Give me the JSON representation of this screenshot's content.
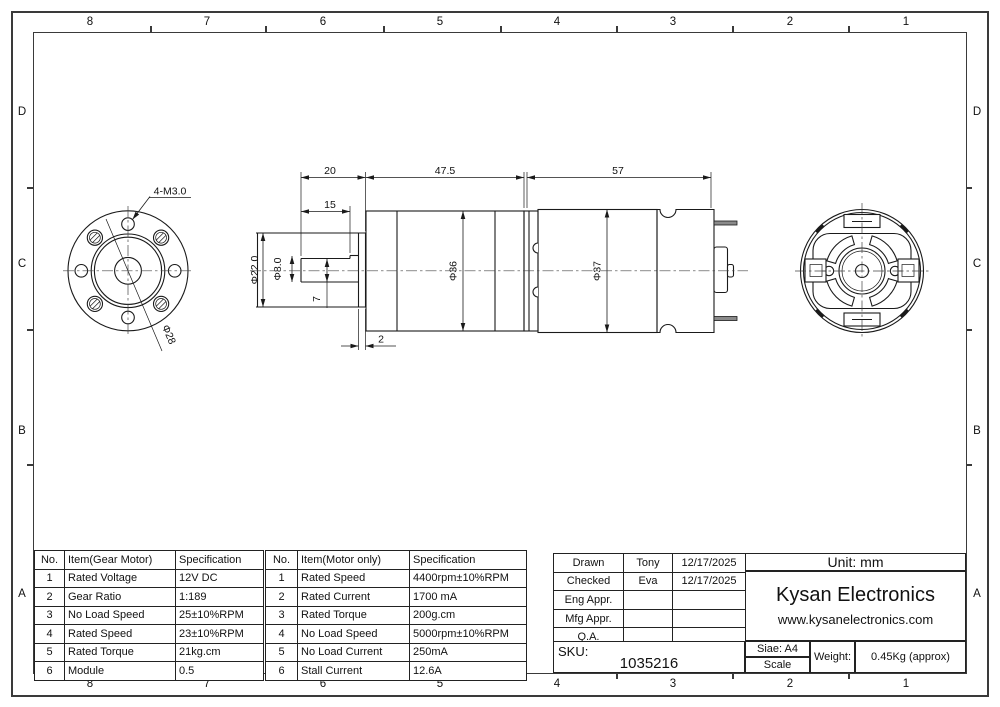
{
  "zones": {
    "top": [
      "8",
      "7",
      "6",
      "5",
      "4",
      "3",
      "2",
      "1"
    ],
    "bottom": [
      "8",
      "7",
      "6",
      "5",
      "4",
      "3",
      "2",
      "1"
    ],
    "left": [
      "D",
      "C",
      "B",
      "A"
    ],
    "right": [
      "D",
      "C",
      "B",
      "A"
    ]
  },
  "drawing": {
    "front_view": {
      "thread_label": "4-M3.0",
      "bolt_circle_label": "Φ28"
    },
    "side_view": {
      "dim_shaft_protrusion": "20",
      "dim_flat_length": "15",
      "dim_gearbox_length": "47.5",
      "dim_motor_length": "57",
      "dia_boss": "Φ22.0",
      "dia_shaft": "Φ8.0",
      "dim_flat_height": "7",
      "dim_flange_thickness": "2",
      "dia_gearbox": "Φ36",
      "dia_motor": "Φ37"
    }
  },
  "tables": {
    "gear_motor": {
      "headers": [
        "No.",
        "Item(Gear Motor)",
        "Specification"
      ],
      "rows": [
        [
          "1",
          "Rated Voltage",
          "12V DC"
        ],
        [
          "2",
          "Gear Ratio",
          "1:189"
        ],
        [
          "3",
          "No Load Speed",
          "25±10%RPM"
        ],
        [
          "4",
          "Rated Speed",
          "23±10%RPM"
        ],
        [
          "5",
          "Rated Torque",
          "21kg.cm"
        ],
        [
          "6",
          "Module",
          "0.5"
        ]
      ]
    },
    "motor_only": {
      "headers": [
        "No.",
        "Item(Motor only)",
        "Specification"
      ],
      "rows": [
        [
          "1",
          "Rated Speed",
          "4400rpm±10%RPM"
        ],
        [
          "2",
          "Rated Current",
          "1700 mA"
        ],
        [
          "3",
          "Rated Torque",
          "200g.cm"
        ],
        [
          "4",
          "No Load Speed",
          "5000rpm±10%RPM"
        ],
        [
          "5",
          "No Load Current",
          "250mA"
        ],
        [
          "6",
          "Stall Current",
          "12.6A"
        ]
      ]
    }
  },
  "title_block": {
    "approvals": {
      "rows": [
        [
          "Drawn",
          "Tony",
          "12/17/2025"
        ],
        [
          "Checked",
          "Eva",
          "12/17/2025"
        ],
        [
          "Eng Appr.",
          "",
          ""
        ],
        [
          "Mfg Appr.",
          "",
          ""
        ],
        [
          "Q.A.",
          "",
          ""
        ]
      ]
    },
    "unit": "Unit: mm",
    "company": "Kysan Electronics",
    "website": "www.kysanelectronics.com",
    "sku_label": "SKU:",
    "sku": "1035216",
    "size": "Siae: A4",
    "scale": "Scale",
    "weight_label": "Weight:",
    "weight": "0.45Kg (approx)"
  },
  "colors": {
    "line": "#1a1a1a",
    "frame": "#3a3a3a",
    "background": "#ffffff"
  }
}
